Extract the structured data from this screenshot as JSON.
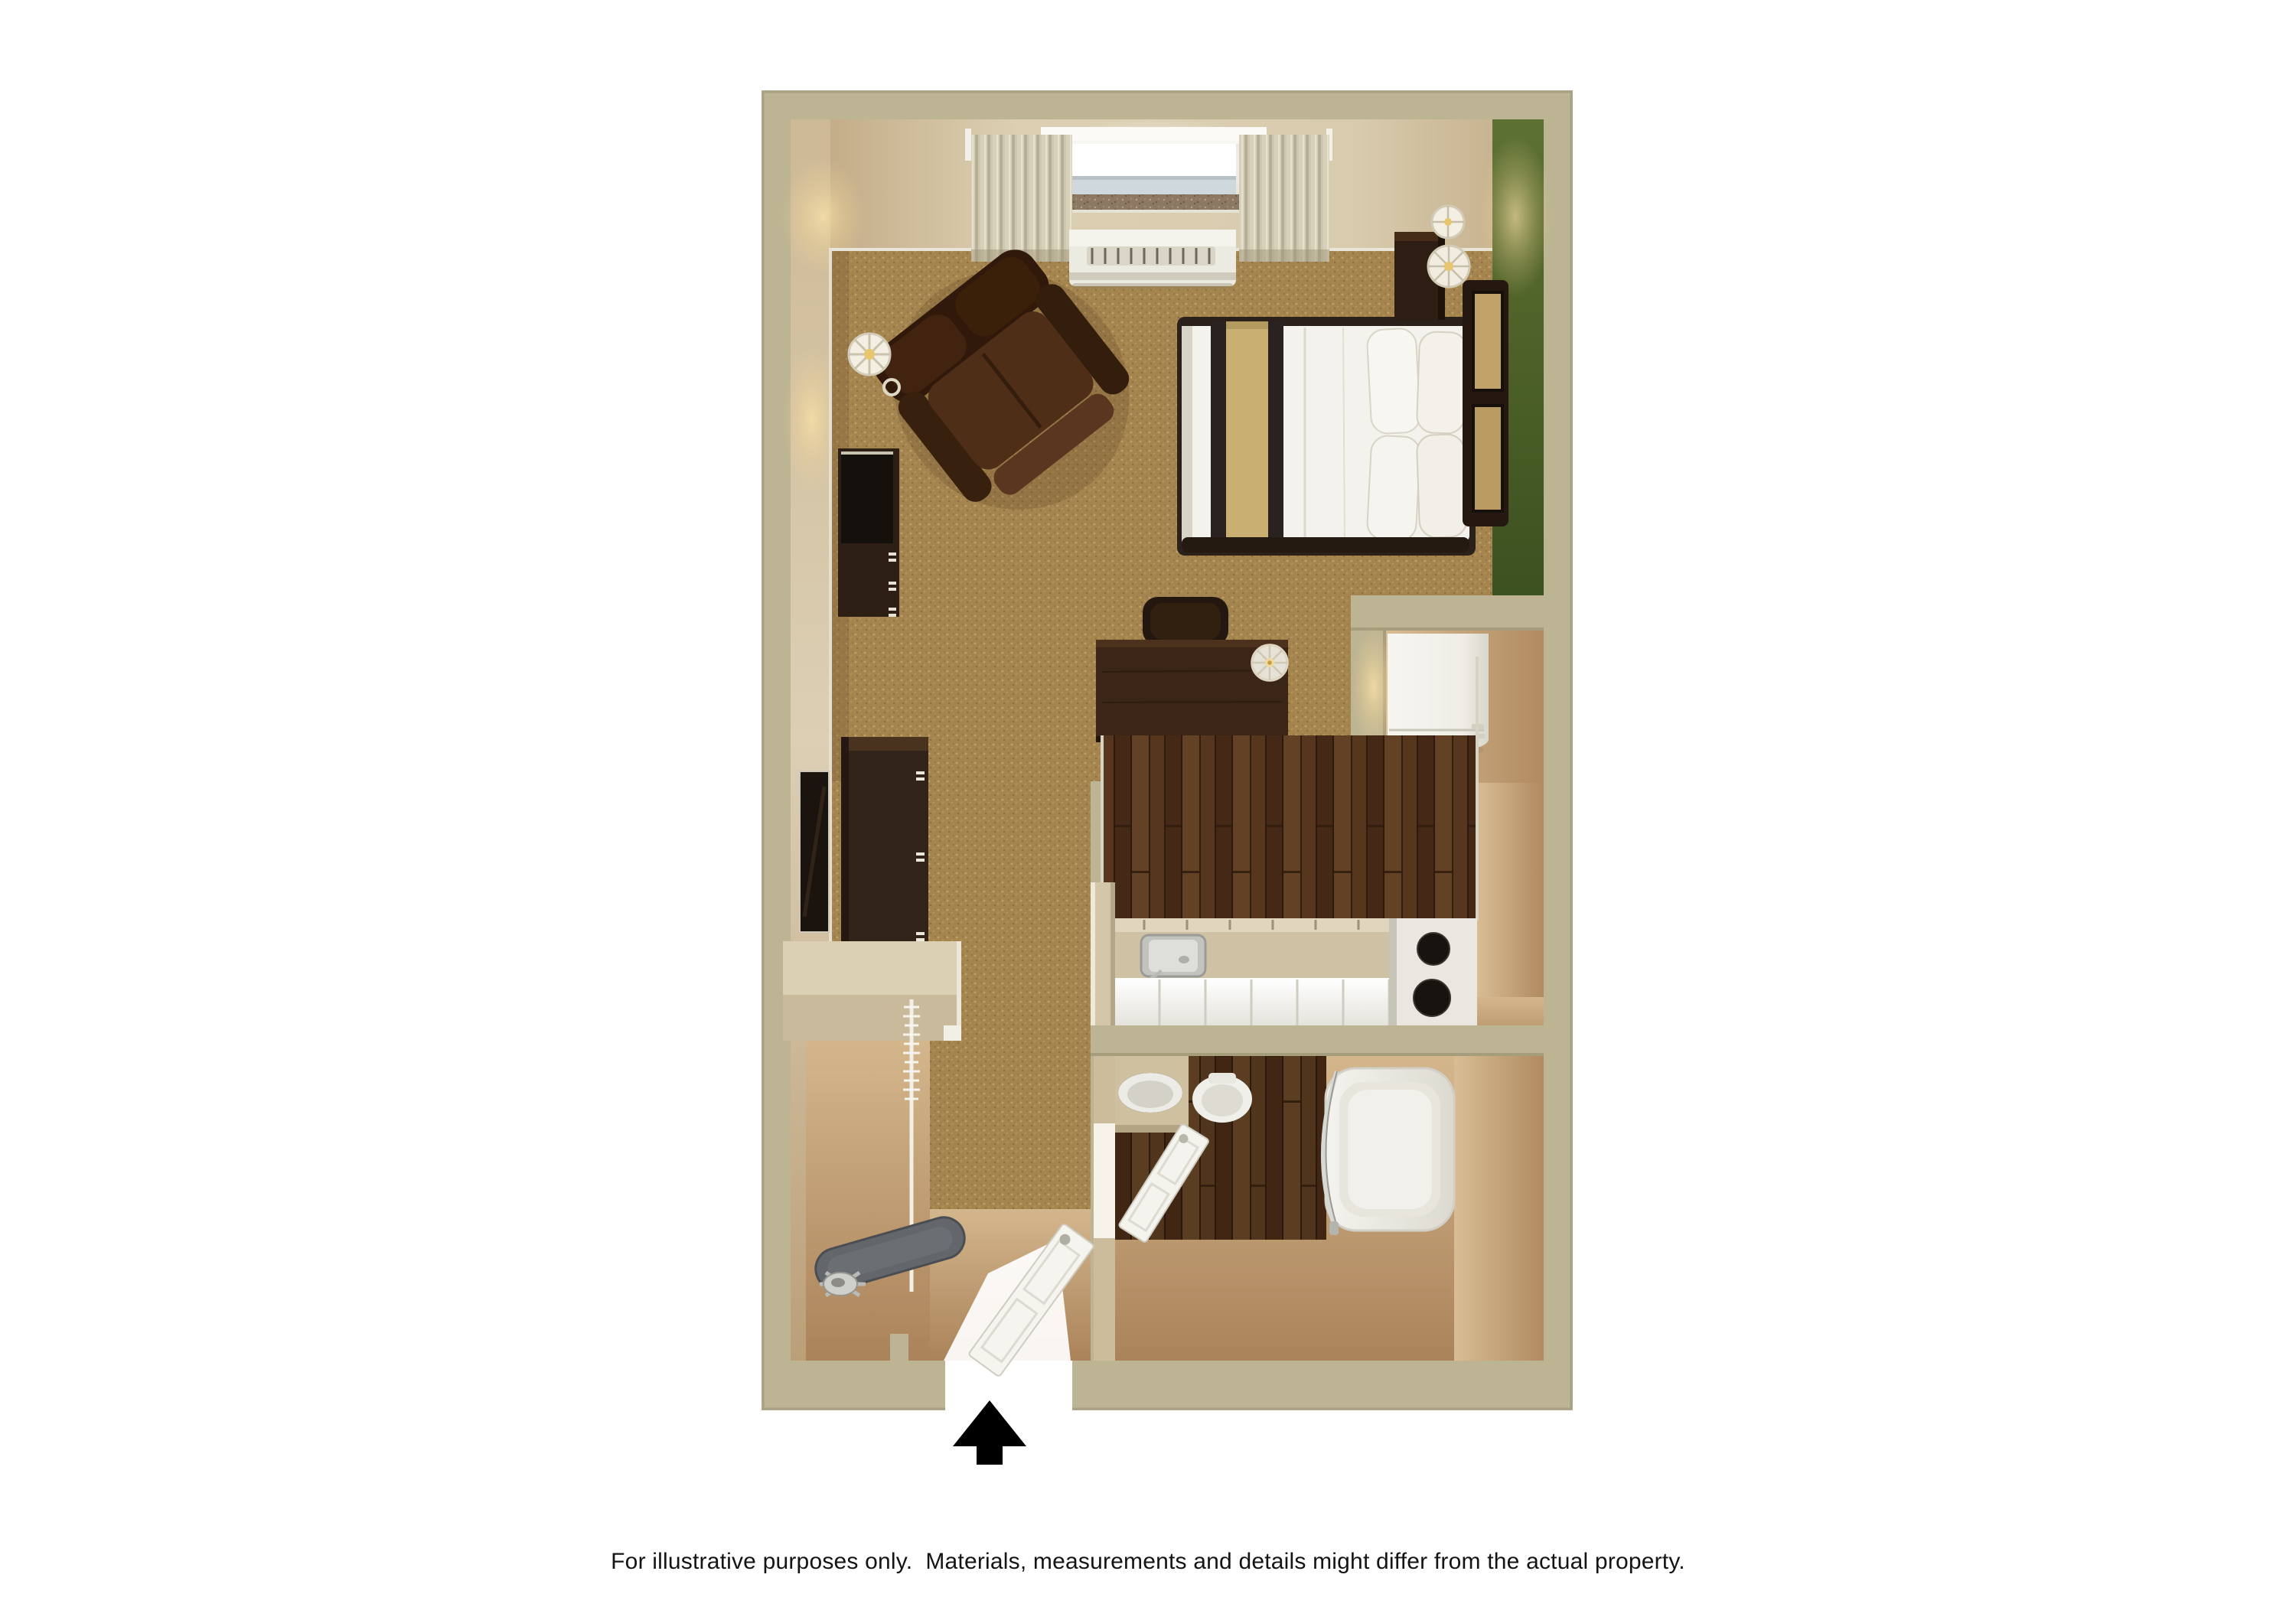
{
  "page": {
    "background_color": "#ffffff"
  },
  "floor_plan": {
    "title": "studio-suite-3d-floor-plan",
    "caption": "For illustrative purposes only.  Materials, measurements and details might differ from the actual property.",
    "entry_arrow": {
      "meaning": "entrance-direction",
      "color": "#000000"
    },
    "colors": {
      "outer_wall": "#bcb492",
      "wall_face_light": "#ddd1b6",
      "wall_face_dark": "#b89c76",
      "accent_wall_green": "#4d6428",
      "carpet": "#a5854f",
      "dark_wood_floor": "#57371f",
      "tan_floor": "#c7a67c",
      "counter_top": "#cfc2a4",
      "cabinet_white": "#f2f1ec",
      "furniture_dark_brown": "#33221a",
      "linen_white": "#f4f2ec",
      "bed_runner_tan": "#c9af72",
      "bed_stripe_dark": "#2a2220"
    },
    "rooms": [
      {
        "name": "living-sleeping-area",
        "floor": "carpet"
      },
      {
        "name": "kitchenette",
        "floor": "dark-wood"
      },
      {
        "name": "bathroom",
        "floor": "dark-wood-and-tan"
      },
      {
        "name": "closet",
        "floor": "tan"
      },
      {
        "name": "entry",
        "floor": "tan"
      }
    ],
    "furniture_and_fixtures": [
      "window-with-curtains",
      "wall-ac-unit",
      "armchair",
      "floor-lamp",
      "tv-console",
      "dresser",
      "wall-mirror",
      "queen-bed",
      "pillows",
      "headboard",
      "nightstand",
      "table-lamps",
      "desk",
      "desk-chair",
      "desk-lamp",
      "refrigerator",
      "kitchen-counter",
      "kitchen-sink",
      "two-burner-stove",
      "half-wall",
      "bathroom-door",
      "vanity-sink",
      "toilet",
      "bathtub",
      "shower-curtain-rod",
      "closet-shelf",
      "clothes-rod-with-hangers",
      "ironing-board",
      "iron",
      "entry-door"
    ]
  }
}
